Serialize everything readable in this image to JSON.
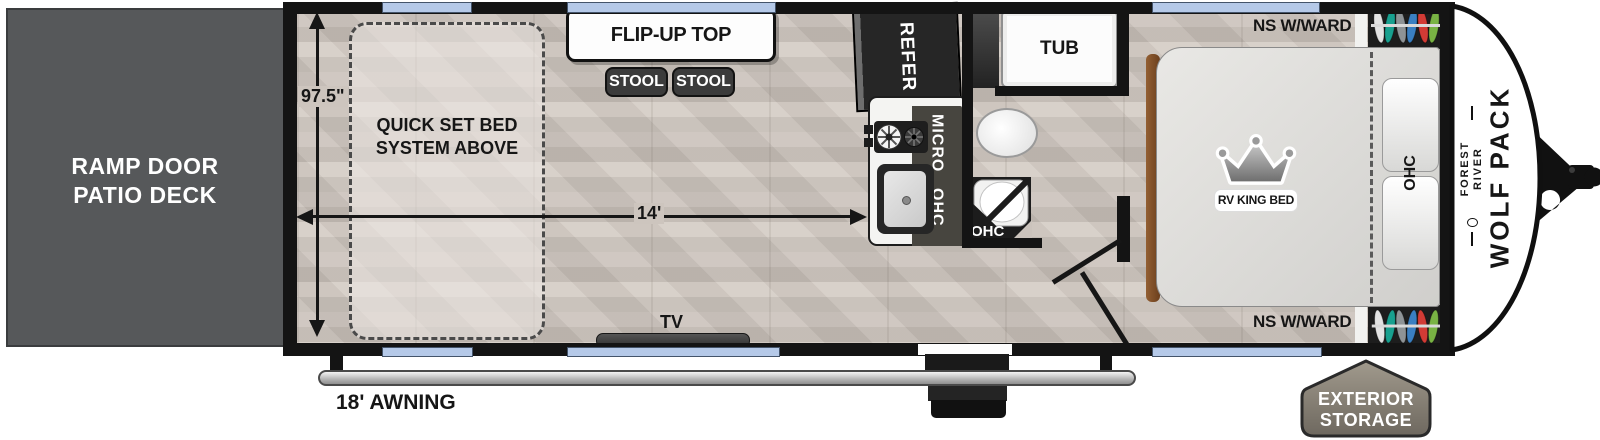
{
  "title": "Travel trailer floorplan",
  "colors": {
    "floor": "#cbc3bc",
    "wall": "#141414",
    "window": "#b5c9e8",
    "ramp_door": "#56585a",
    "furniture_dark": "#3b3b3b",
    "storage_badge": "#8d857a",
    "awning_bar": "#d9d9d9",
    "bed": "#deddda",
    "wood_trim": "#8a5a33"
  },
  "ramp_door": {
    "label": "RAMP DOOR\nPATIO DECK"
  },
  "dimensions": {
    "width": "97.5\"",
    "length": "14'",
    "awning": "18' AWNING"
  },
  "garage": {
    "bed_note": "QUICK SET BED\nSYSTEM ABOVE",
    "flip_up_top": "FLIP-UP TOP",
    "stools": [
      "STOOL",
      "STOOL"
    ],
    "tv": "TV"
  },
  "kitchen": {
    "refrigerator": "REFER",
    "microwave": "MICRO",
    "overhead_cabinet": "OHC"
  },
  "bathroom": {
    "tub": "TUB",
    "shower_cabinet": "OHC"
  },
  "bedroom": {
    "wardrobe_top": "NS W/WARD",
    "wardrobe_bottom": "NS W/WARD",
    "bed": "RV KING BED",
    "overhead_cabinet": "OHC",
    "hanger_colors": [
      "#e3e3e3",
      "#18a08f",
      "#8e9396",
      "#3a7fc1",
      "#d23b35",
      "#79b344"
    ]
  },
  "exterior": {
    "brand": "FOREST RIVER",
    "model": "WOLF PACK",
    "storage": "EXTERIOR\nSTORAGE"
  }
}
